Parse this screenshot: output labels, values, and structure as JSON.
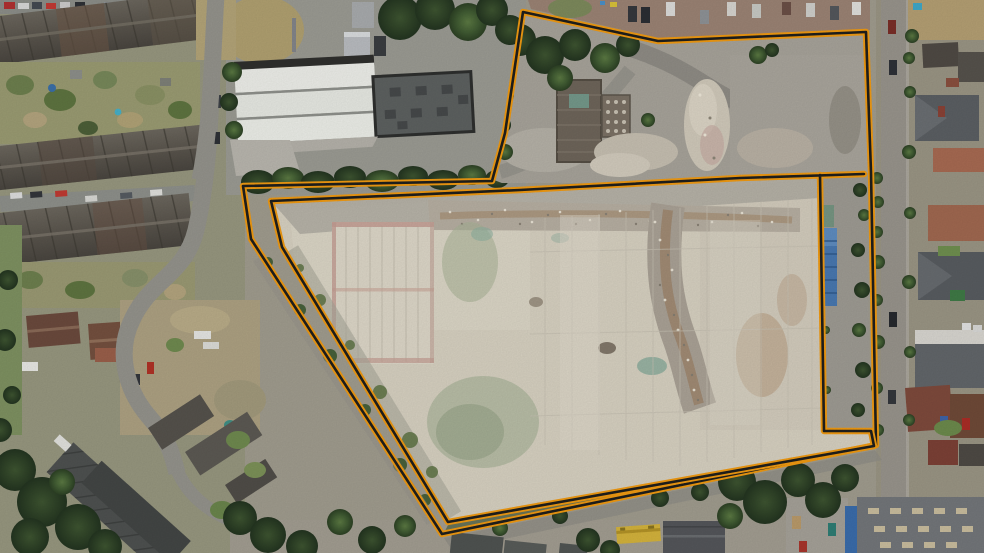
{
  "scene": {
    "type": "aerial-photo",
    "description": "Aerial drone photograph of a cleared demolition site with a large pale concrete slab, outlined by an orange and black site boundary. Terraced housing and curved streets on the left, a white-roofed warehouse at top, a tree-lined corridor and residential street on the right, industrial units and a yellow vehicle along the bottom.",
    "width": 984,
    "height": 553
  },
  "palette": {
    "boundary_orange": "#f09a12",
    "boundary_core": "#1f1f1d",
    "concrete_slab": "#d7d1c1",
    "tarmac": "#96948c",
    "tree_dark": "#3a5130",
    "roof_dark": "#55524c",
    "roof_red": "#7e4a3c",
    "warehouse_white": "#edeee9",
    "container_blue": "#4878b0",
    "vehicle_yellow": "#d4b33c"
  },
  "boundary": {
    "label": "site-boundary",
    "outer": [
      [
        492,
        181
      ],
      [
        505,
        133
      ],
      [
        523,
        12
      ],
      [
        658,
        41
      ],
      [
        866,
        32
      ],
      [
        871,
        172
      ],
      [
        876,
        445
      ],
      [
        442,
        534
      ],
      [
        251,
        239
      ],
      [
        243,
        186
      ],
      [
        492,
        181
      ]
    ],
    "inner": [
      [
        864,
        174
      ],
      [
        740,
        178
      ],
      [
        520,
        190
      ],
      [
        271,
        201
      ],
      [
        282,
        247
      ],
      [
        448,
        522
      ],
      [
        874,
        446
      ],
      [
        871,
        431
      ],
      [
        824,
        431
      ],
      [
        820,
        175
      ]
    ]
  }
}
